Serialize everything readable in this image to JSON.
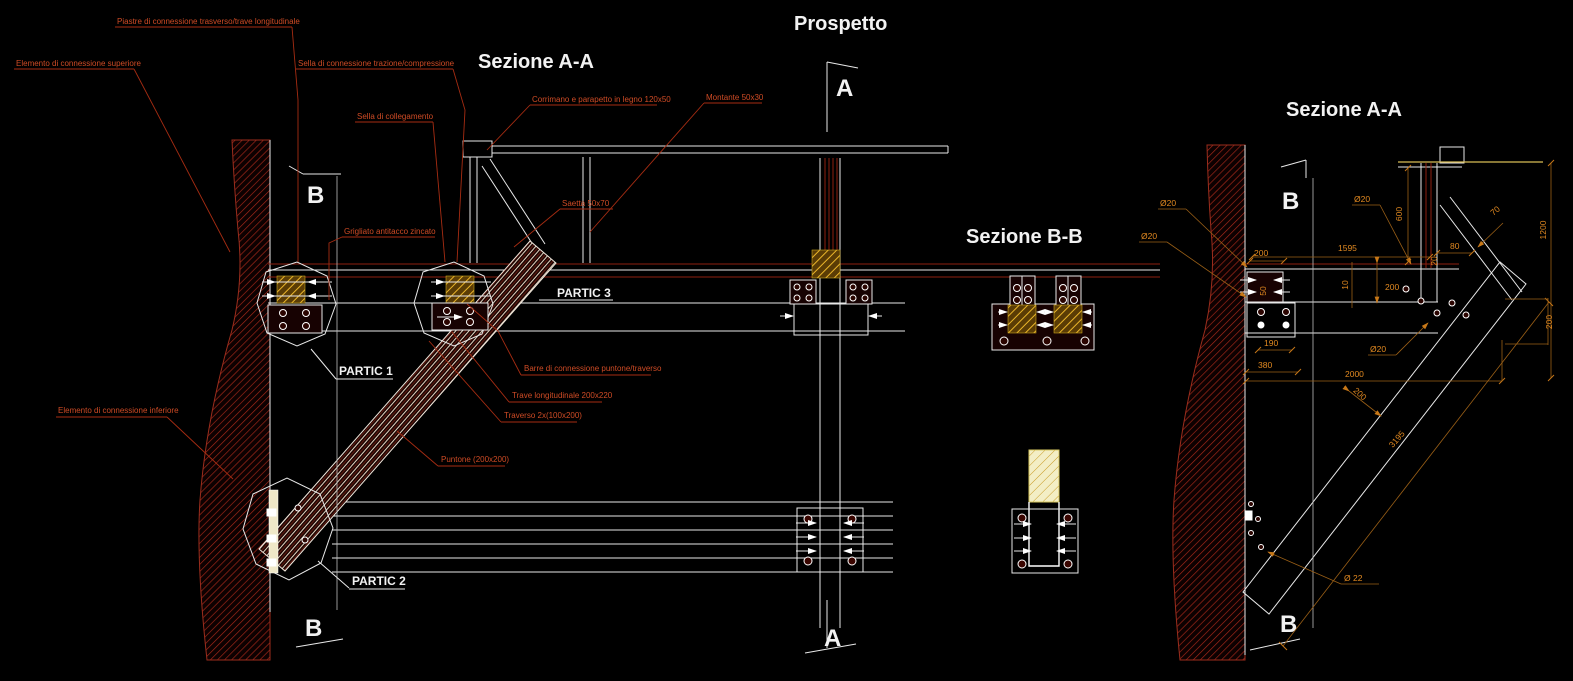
{
  "drawing": {
    "titles": {
      "section_aa_left": "Sezione A-A",
      "prospetto": "Prospetto",
      "section_bb": "Sezione B-B",
      "section_aa_right": "Sezione A-A"
    },
    "markers": {
      "a": "A",
      "b": "B"
    },
    "details": {
      "partic_1": "PARTIC 1",
      "partic_2": "PARTIC 2",
      "partic_3": "PARTIC 3"
    },
    "annotations": {
      "piastre": "Piastre di connessione trasverso/trave longitudinale",
      "elemento_sup": "Elemento di connessione superiore",
      "sella_trazione": "Sella di connessione trazione/compressione",
      "sella_collegamento": "Sella di collegamento",
      "corrimano": "Corrimano e parapetto in legno 120x50",
      "montante": "Montante 50x30",
      "saetta": "Saetta 50x70",
      "grigliato": "Grigliato antitacco zincato",
      "elemento_inf": "Elemento di connessione inferiore",
      "barre": "Barre di connessione puntone/traverso",
      "trave": "Trave longitudinale 200x220",
      "traverso": "Traverso 2x(100x200)",
      "puntone": "Puntone (200x200)"
    },
    "dimensions": {
      "dia20": "Ø20",
      "dia22": "Ø 22",
      "len1595": "1595",
      "len2000": "2000",
      "len3195": "3195",
      "h600": "600",
      "h1200": "1200",
      "w70": "70",
      "w80": "80",
      "w20": "20",
      "w10": "10",
      "w200": "200",
      "w50": "50",
      "w190": "190",
      "w380": "380"
    },
    "colors": {
      "background": "#000000",
      "line_red": "#8e1f10",
      "line_white": "#e9e9e9",
      "annotation_text": "#cf4b25",
      "dimension_text": "#e08820",
      "gold_hatch": "#d9a01e",
      "pale_wood": "#f2ecc0"
    }
  }
}
